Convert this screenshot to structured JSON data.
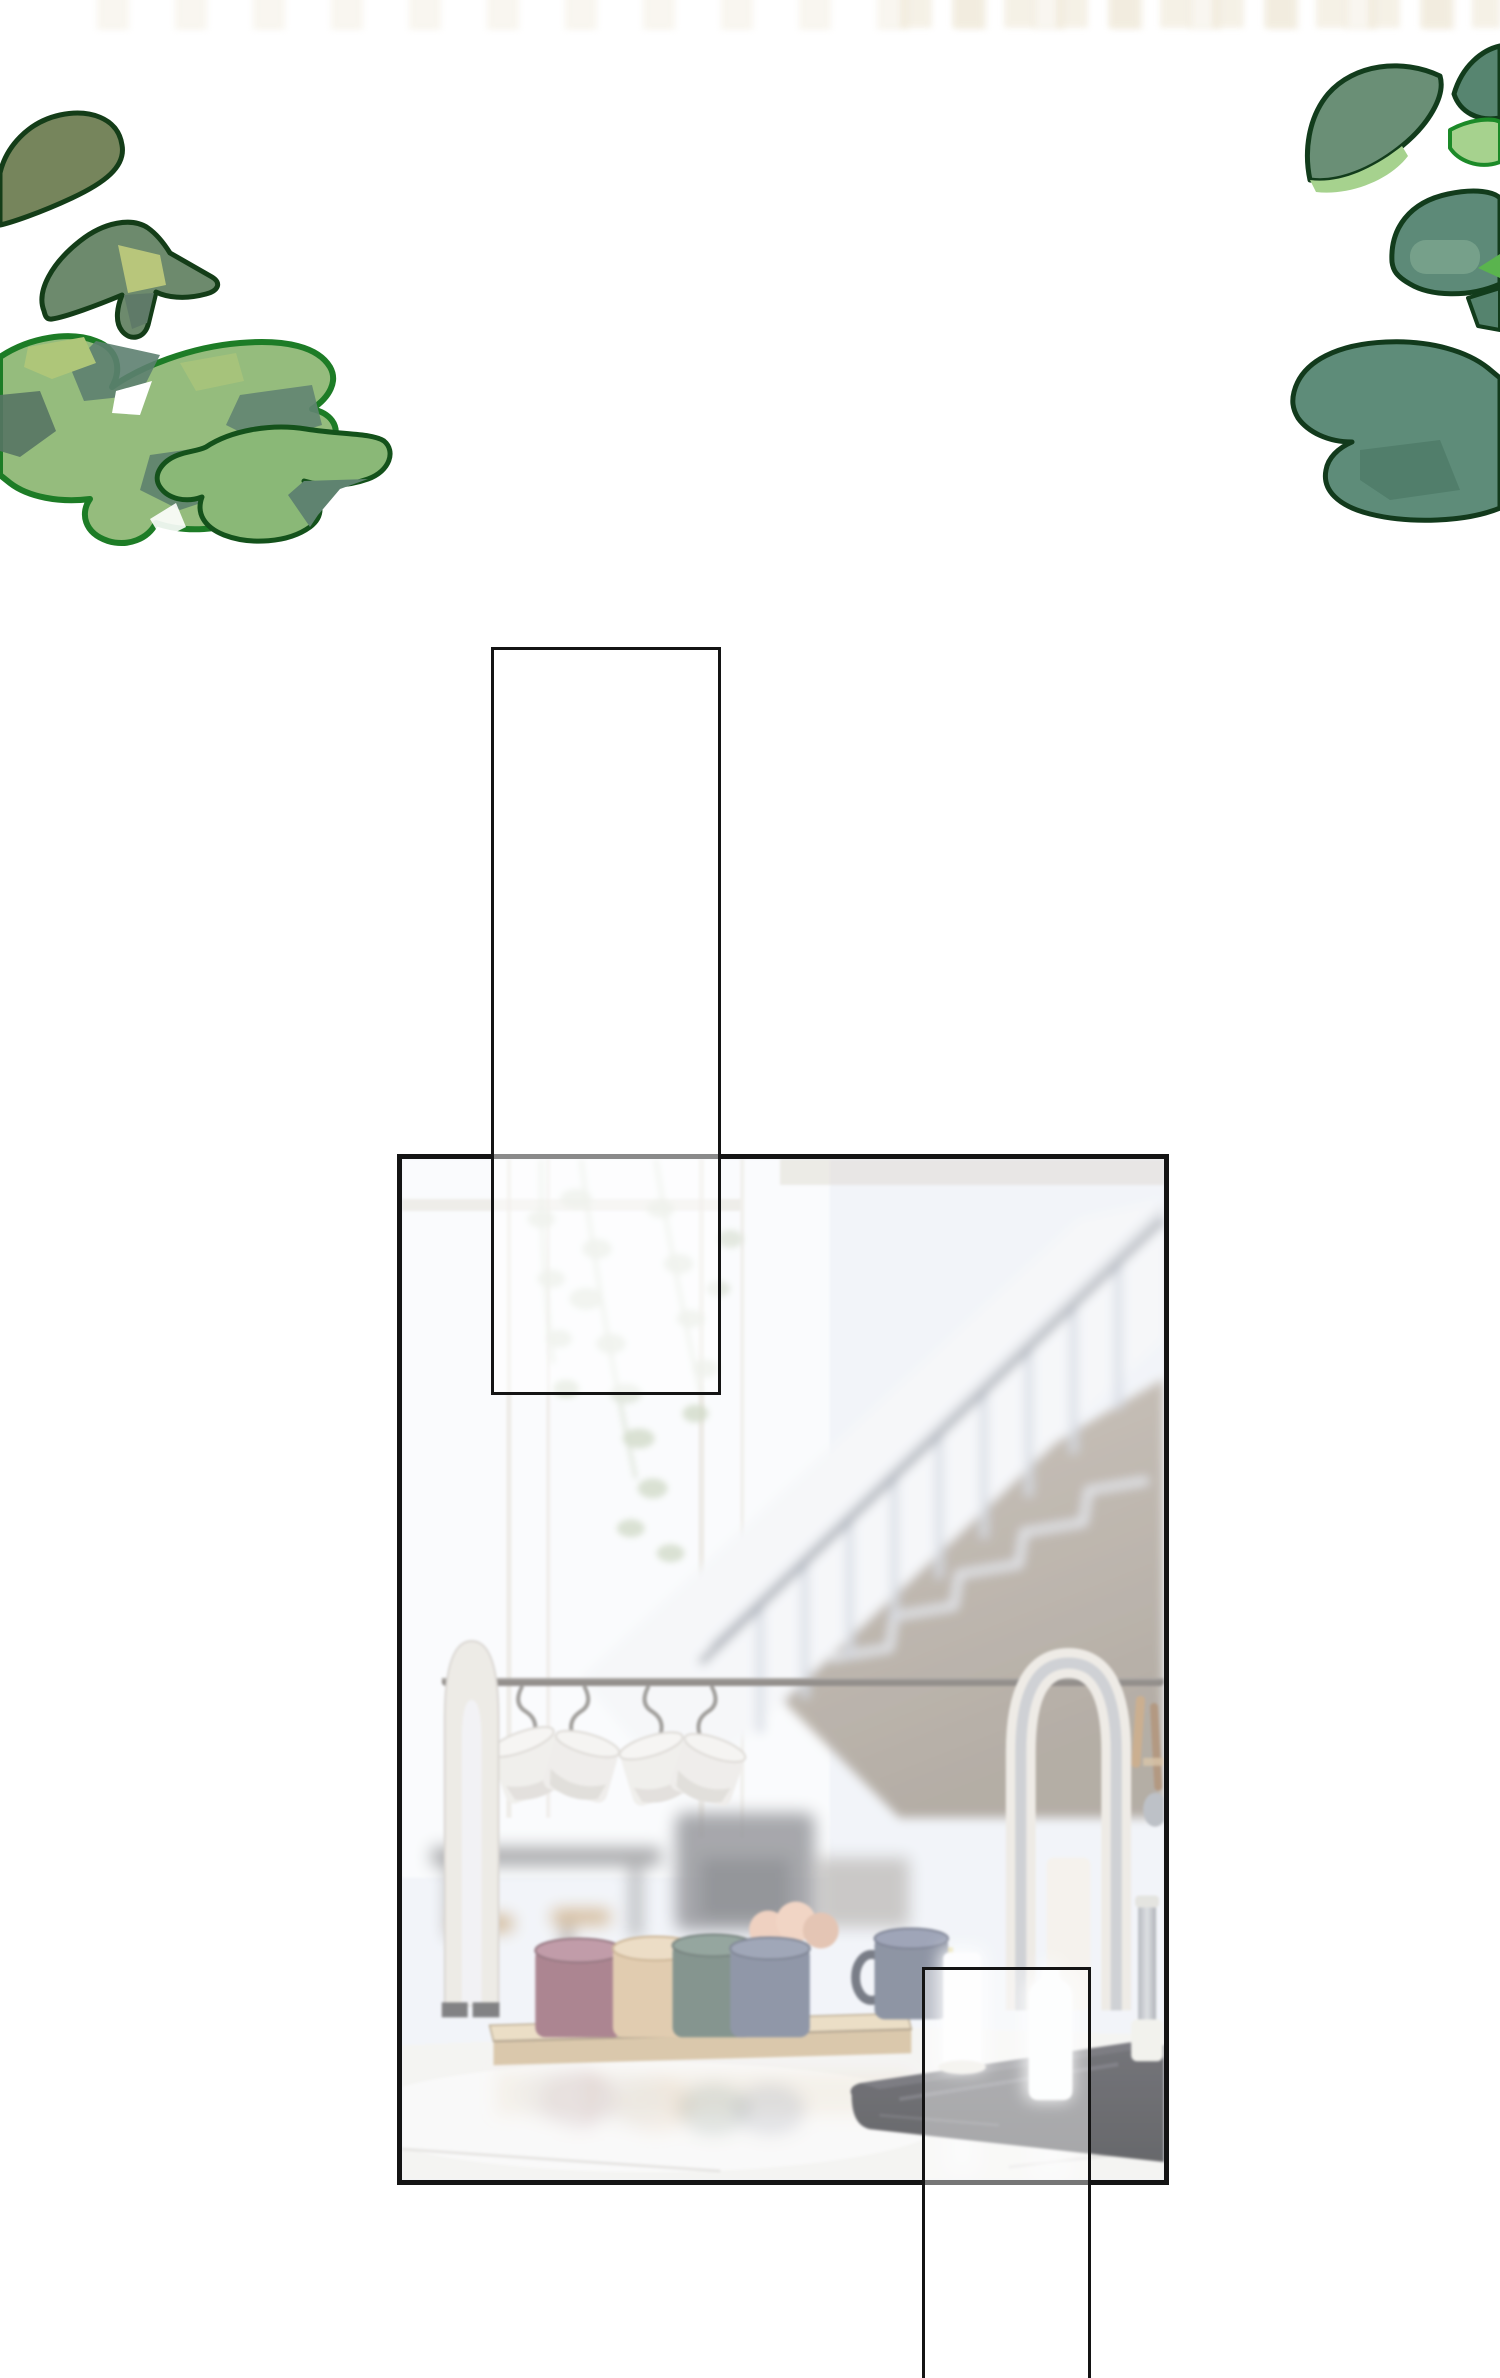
{
  "page": {
    "width_px": 1500,
    "height_px": 2378,
    "background": "#ffffff",
    "kind": "wordless comic transition page",
    "text_content": "none"
  },
  "css_vars": {
    "page-bg": "#ffffff",
    "panel-border": "#141414",
    "frost-tall": "rgba(255,255,255,0.5)",
    "frost-small": "rgba(255,255,255,0.42)",
    "watermark-cream": "rgba(238,231,214,0.75)"
  },
  "decor": {
    "top_watermark": {
      "description": "very faint cream band of cropped text shapes along top edge, stronger on right half",
      "color": "#eee7d6"
    },
    "leaves_left": {
      "outline_dark": "#143d18",
      "outline_bright": "#1d7c26",
      "fills": [
        "#76855c",
        "#6d8a6d",
        "#b8c67b",
        "#95bc7d",
        "#5d8070",
        "#aec679",
        "#8ab877",
        "#5f8370"
      ]
    },
    "leaves_right": {
      "outline_dark": "#123c1c",
      "outline_bright": "#1c8a28",
      "fills": [
        "#6a8f76",
        "#a6d28e",
        "#578570",
        "#5d8a78",
        "#7aa38d",
        "#5e8c79",
        "#4e7a68"
      ]
    }
  },
  "panels": {
    "tall_overlay_rect": {
      "border": "#141414",
      "fill": "rgba(255,255,255,0.5)",
      "note": "frosted rectangle crossing top edge of kitchen panel"
    },
    "small_overlay_rect": {
      "border": "#141414",
      "fill": "rgba(255,255,255,0.42)",
      "note": "frosted rectangle over stove area, cropped by page bottom edge"
    },
    "kitchen_panel": {
      "border": "#141414",
      "scene": {
        "description": "blurred bright kitchen interior with staircase",
        "background": "#eef1f7",
        "window_light": "#fbfcfd",
        "window_frame": "#d9cfc1",
        "staircase_band": "#f4f5f8",
        "stair_rail": "#5c6575",
        "balusters": "#c3cad6",
        "understair_wall": [
          "#b3a698",
          "#8c8072"
        ],
        "hanging_plant": [
          "#cdd5c2",
          "#b9c7a8"
        ],
        "rack_rail": "#57504a",
        "rack_arches": "#e7e1da",
        "rack_arch_metal": "#b0b4ba",
        "hanging_mugs": "#ebe8e3",
        "tray_wood": [
          "#e2cda6",
          "#c9ab7c"
        ],
        "counter_mugs": {
          "maroon": "#7e4052",
          "tan": "#d4b084",
          "teal": "#41594f",
          "navy": "#525d76",
          "big_navy": "#4f5870"
        },
        "eggs": "#e9b89d",
        "yellow_object": "#d9c65e",
        "stove": "#17171c",
        "glowing_bottles": "#ffffff",
        "countertop": "#f2f0ed"
      }
    }
  }
}
